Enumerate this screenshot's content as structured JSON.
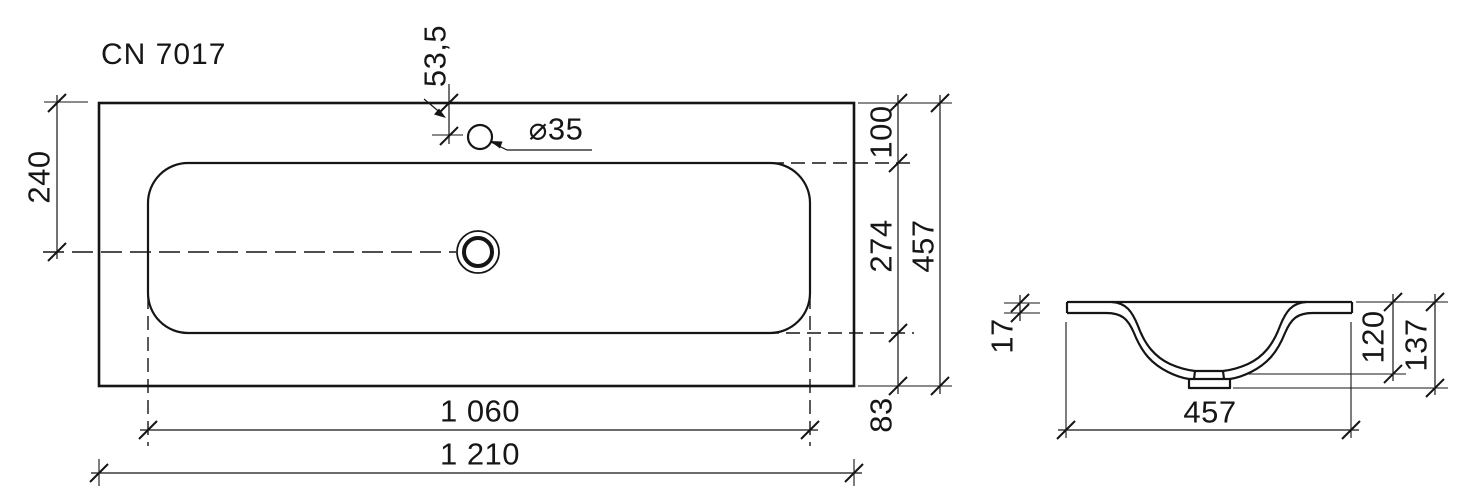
{
  "title": "CN 7017",
  "plan_view": {
    "description": "washbasin top view",
    "dims": {
      "top_to_centerline": "240",
      "faucet_hole_offset": "53,5",
      "faucet_hole_diameter": "⌀35",
      "top_rim": "100",
      "basin_inner_depth": "274",
      "overall_depth": "457",
      "bottom_rim": "83",
      "basin_inner_width": "1 060",
      "overall_width": "1 210"
    }
  },
  "section_view": {
    "description": "washbasin cross-section",
    "dims": {
      "rim_thickness": "17",
      "bowl_depth_inner": "120",
      "overall_height": "137",
      "width": "457"
    }
  }
}
